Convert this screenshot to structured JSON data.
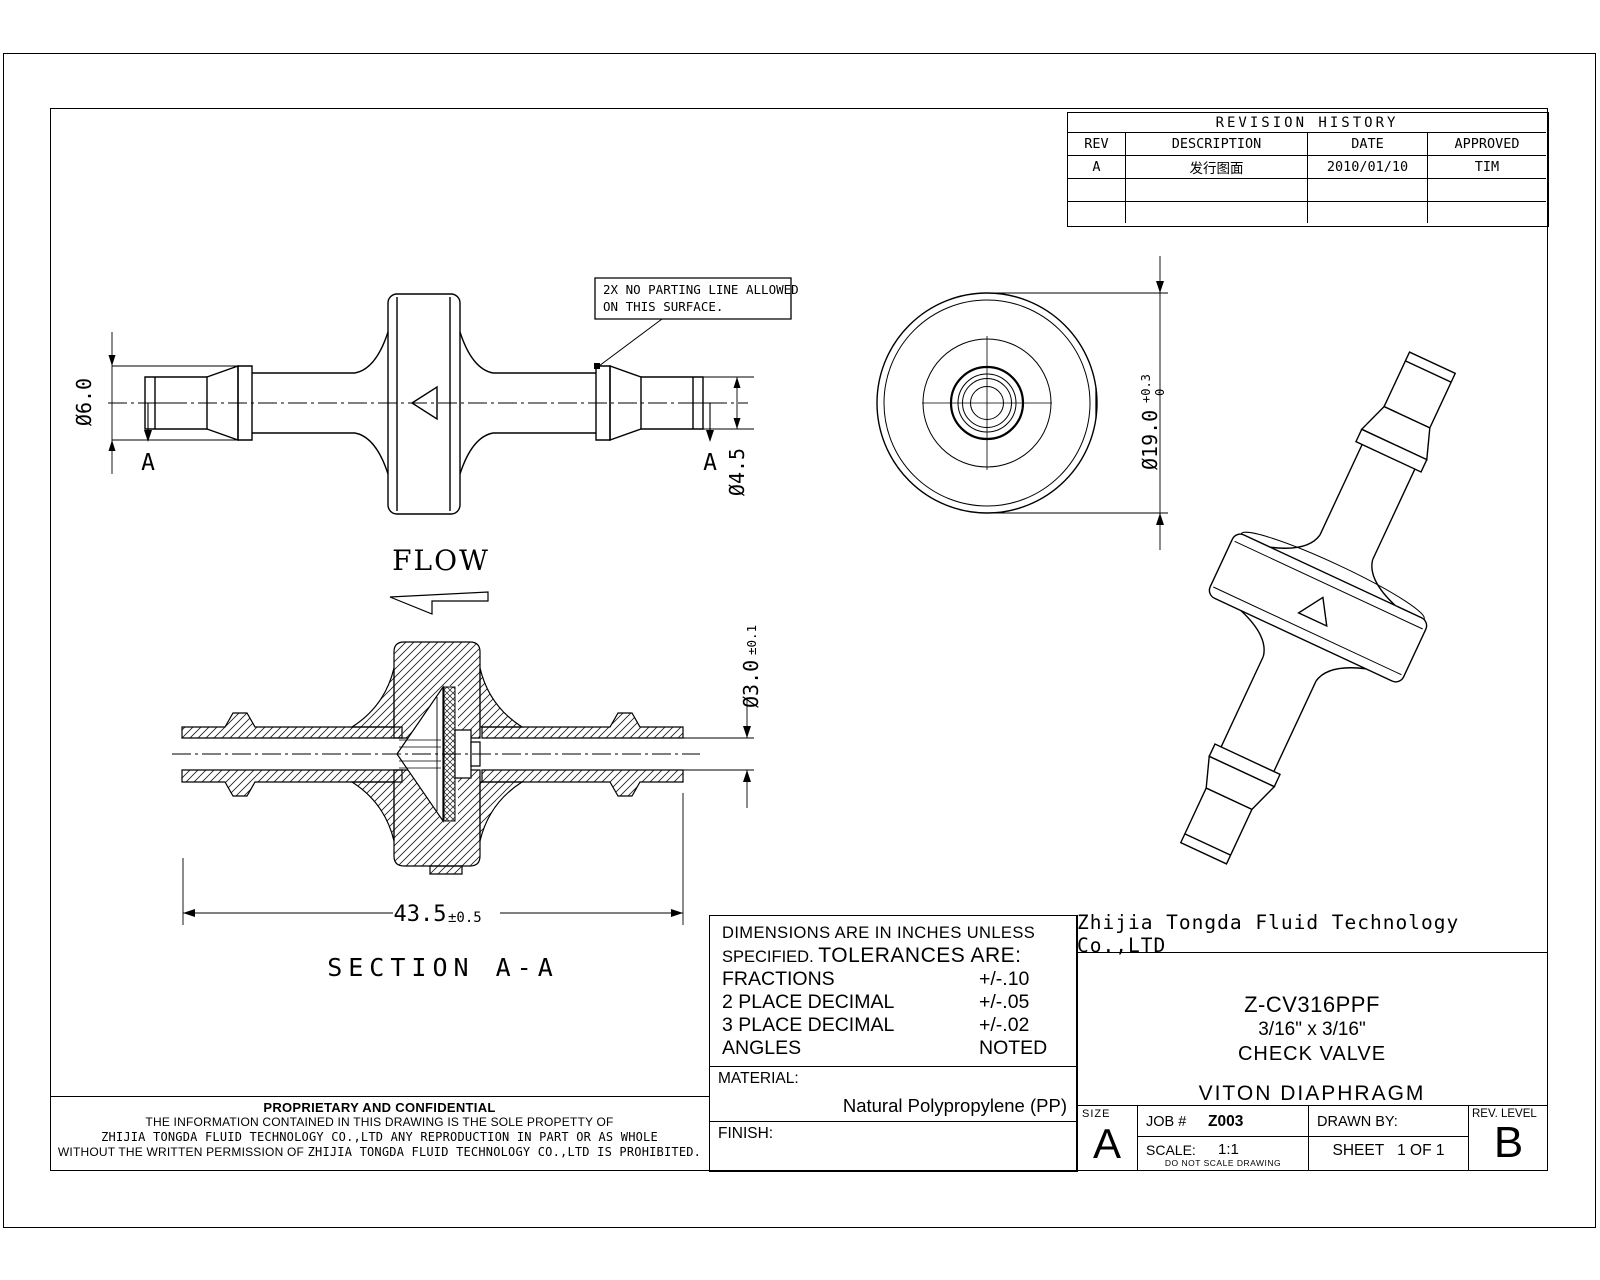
{
  "ink": "#000000",
  "drawing": {
    "note_box": {
      "line1": "2X NO PARTING LINE ALLOWED",
      "line2": "ON THIS SURFACE."
    },
    "flow_label": "FLOW",
    "section_label": "SECTION A-A",
    "section_marker_left": "A",
    "section_marker_right": "A",
    "dims": {
      "barb_od": "Ø6.0",
      "tip_od": "Ø4.5",
      "body_od": "Ø19.0",
      "body_od_tol_plus": "+0.3",
      "body_od_tol_minus": "0",
      "bore": "Ø3.0",
      "bore_tol": "±0.1",
      "overall_length": "43.5",
      "overall_length_tol": "±0.5"
    }
  },
  "revision_table": {
    "title": "REVISION HISTORY",
    "columns": [
      "REV",
      "DESCRIPTION",
      "DATE",
      "APPROVED"
    ],
    "rows": [
      {
        "rev": "A",
        "description": "发行图面",
        "date": "2010/01/10",
        "approved": "TIM"
      },
      {
        "rev": "",
        "description": "",
        "date": "",
        "approved": ""
      },
      {
        "rev": "",
        "description": "",
        "date": "",
        "approved": ""
      }
    ]
  },
  "tolerance_block": {
    "line1": "DIMENSIONS ARE IN INCHES UNLESS",
    "line2_prefix": "SPECIFIED.",
    "line2_main": "TOLERANCES ARE:",
    "rows": [
      {
        "name": "FRACTIONS",
        "value": "+/-.10"
      },
      {
        "name": "2 PLACE DECIMAL",
        "value": "+/-.05"
      },
      {
        "name": "3 PLACE DECIMAL",
        "value": "+/-.02"
      },
      {
        "name": "ANGLES",
        "value": "NOTED"
      }
    ],
    "material_label": "MATERIAL:",
    "material_value": "Natural Polypropylene (PP)",
    "finish_label": "FINISH:"
  },
  "title_block": {
    "company": "Zhijia Tongda Fluid Technology Co.,LTD",
    "part_number": "Z-CV316PPF",
    "size_spec": "3/16\" x 3/16\"",
    "part_type": "CHECK VALVE",
    "material_note": "VITON DIAPHRAGM",
    "size_label": "SIZE",
    "size_value": "A",
    "job_label": "JOB #",
    "job_value": "Z003",
    "scale_label": "SCALE:",
    "scale_value": "1:1",
    "scale_note": "DO NOT SCALE DRAWING",
    "drawn_by_label": "DRAWN BY:",
    "sheet_label": "SHEET",
    "sheet_value": "1 OF 1",
    "rev_level_label": "REV. LEVEL",
    "rev_level_value": "B"
  },
  "proprietary": {
    "title": "PROPRIETARY AND CONFIDENTIAL",
    "line1": "THE INFORMATION CONTAINED IN THIS DRAWING IS THE SOLE PROPETTY OF",
    "line2": "ZHIJIA TONGDA FLUID TECHNOLOGY CO.,LTD ANY REPRODUCTION IN PART OR AS WHOLE",
    "line3a": "WITHOUT THE WRITTEN PERMISSION OF",
    "line3b": "ZHIJIA TONGDA FLUID TECHNOLOGY CO.,LTD IS PROHIBITED."
  }
}
